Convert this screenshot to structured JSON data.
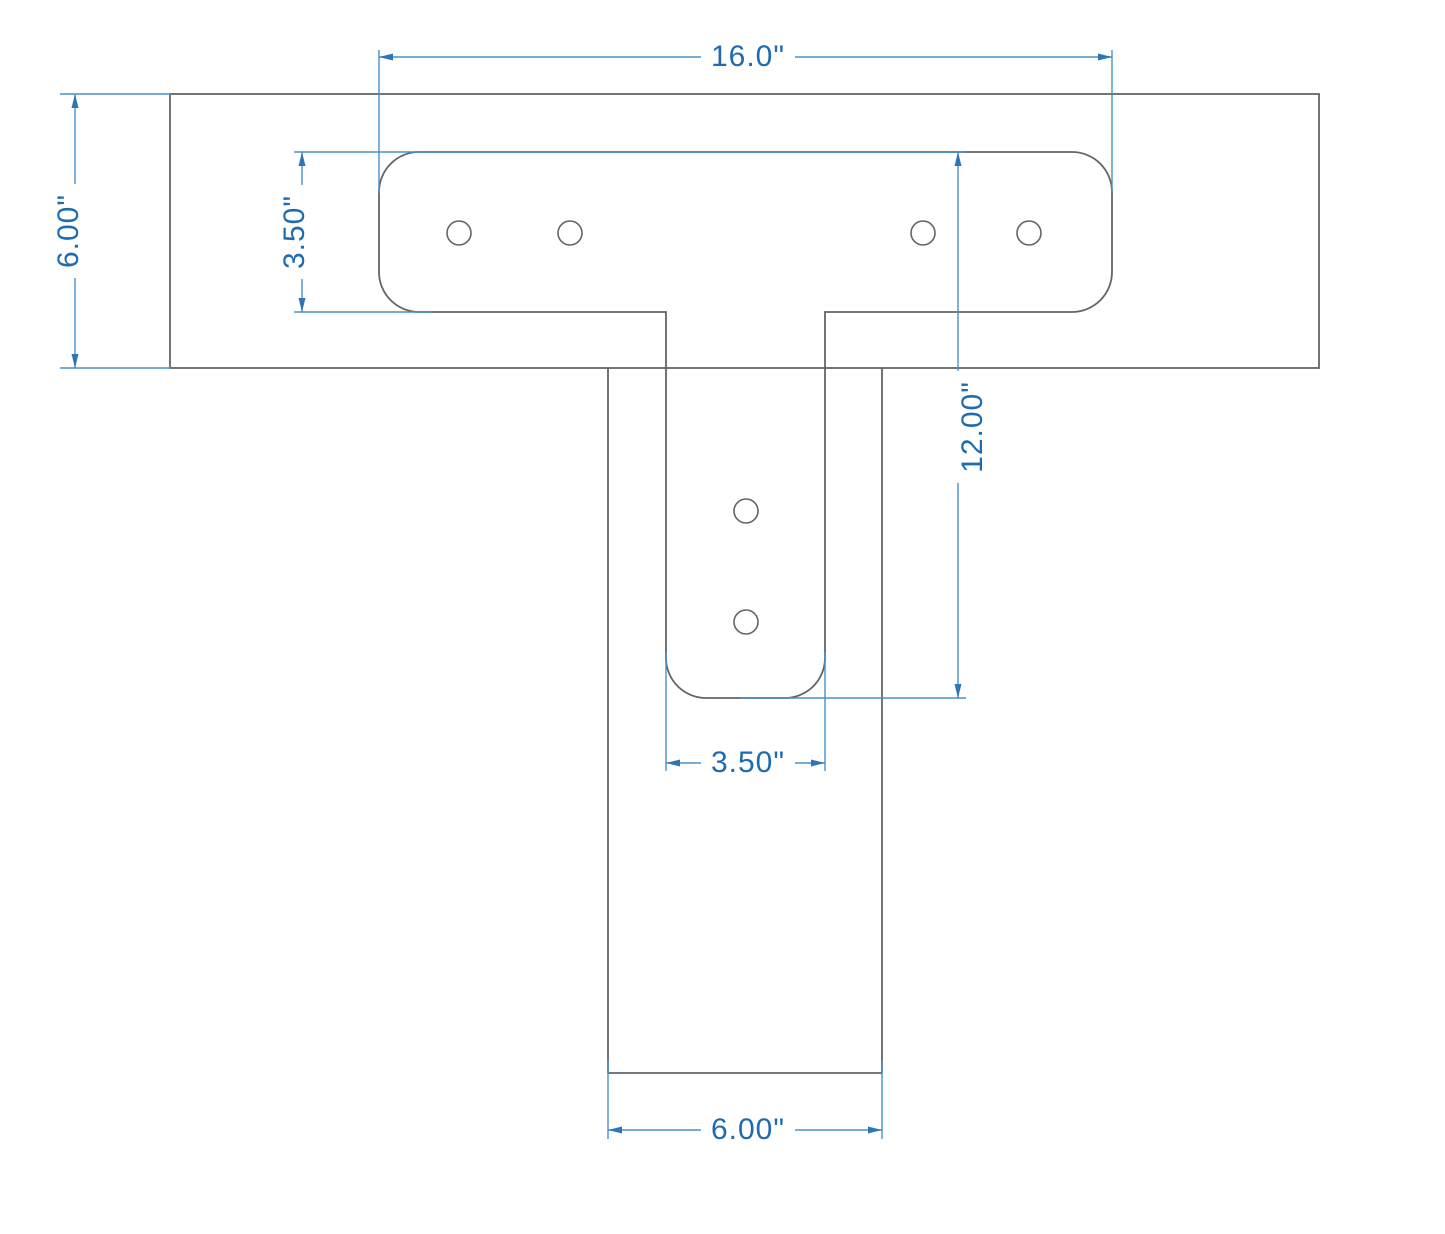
{
  "drawing": {
    "type": "technical-dimension-drawing",
    "subject": "T-bracket steel plate on beam and post",
    "colors": {
      "outline": "#636466",
      "dimension_line": "#4a90ca",
      "arrow": "#2e75b6",
      "dimension_text": "#1e6bb0",
      "background": "#ffffff"
    },
    "dimensions": {
      "plate_width": "16.0\"",
      "beam_height": "6.00\"",
      "plate_arm_height": "3.50\"",
      "vertical_extent": "12.00\"",
      "tongue_width": "3.50\"",
      "post_width": "6.00\""
    },
    "hole_count": 6
  }
}
